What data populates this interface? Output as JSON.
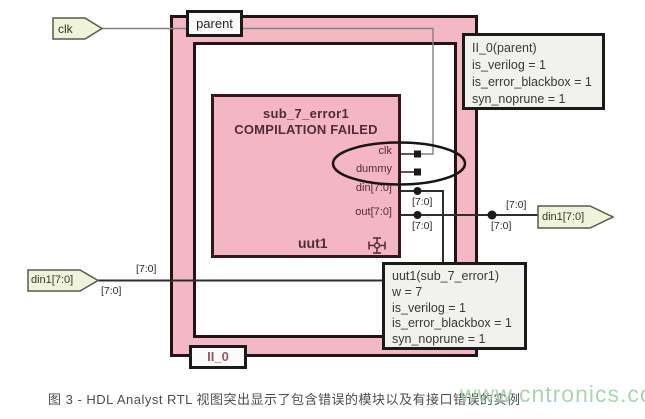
{
  "diagram": {
    "top_port": {
      "label": "clk"
    },
    "left_port": {
      "label": "din1[7:0]"
    },
    "right_port": {
      "label": "din1[7:0]"
    },
    "parent_block": {
      "module_label": "parent",
      "instance_label": "II_0"
    },
    "sub_block": {
      "title": "sub_7_error1",
      "status": "COMPILATION FAILED",
      "instance_name": "uut1",
      "ports": [
        "clk",
        "dummy",
        "din[7:0]",
        "out[7:0]"
      ]
    },
    "bus_label": "[7:0]",
    "parent_annotation": {
      "title": "II_0(parent)",
      "lines": [
        "is_verilog = 1",
        "is_error_blackbox = 1",
        "syn_noprune = 1"
      ]
    },
    "uut1_annotation": {
      "title": "uut1(sub_7_error1)",
      "lines": [
        "w = 7",
        "is_verilog = 1",
        "is_error_blackbox = 1",
        "syn_noprune = 1"
      ]
    },
    "colors": {
      "module_fill": "#f4b7c4",
      "outline": "#231216",
      "port_arrow_fill": "#eef3da",
      "annotation_fill": "#f1f1ee",
      "error_text": "#4e2c3a",
      "watermark_green": "#9ccf9f"
    }
  },
  "caption": "图 3 - HDL Analyst RTL 视图突出显示了包含错误的模块以及有接口错误的实例",
  "watermark": "www.cntronics.com"
}
